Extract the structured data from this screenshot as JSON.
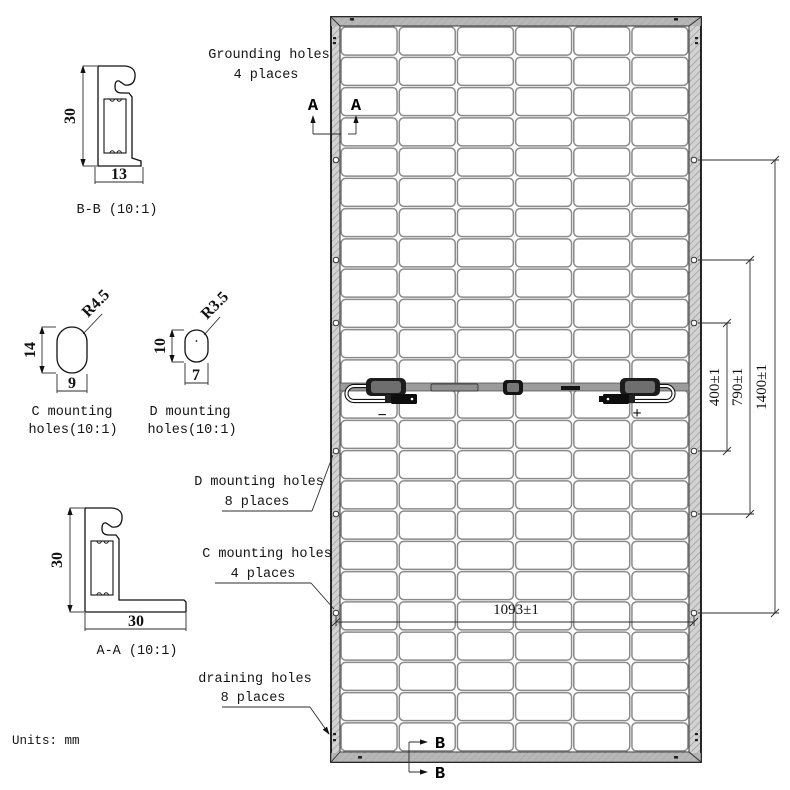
{
  "drawing_title": "solar-panel-rear-view-technical-drawing",
  "units_label": "Units: mm",
  "panel": {
    "columns": 6,
    "rows": 24
  },
  "sections": {
    "a": "A",
    "b": "B"
  },
  "polarity": {
    "minus": "−",
    "plus": "+"
  },
  "dimensions": {
    "width_holes": "1093±1",
    "v400": "400±1",
    "v790": "790±1",
    "v1400": "1400±1"
  },
  "callouts": {
    "grounding": {
      "line1": "Grounding holes",
      "line2": "4 places"
    },
    "d_mounting": {
      "line1": "D mounting holes",
      "line2": "8 places"
    },
    "c_mounting": {
      "line1": "C mounting holes",
      "line2": "4 places"
    },
    "draining": {
      "line1": "draining holes",
      "line2": "8 places"
    }
  },
  "details": {
    "bb_profile": {
      "label": "B-B (10:1)",
      "dim_height": "30",
      "dim_width": "13"
    },
    "aa_profile": {
      "label": "A-A (10:1)",
      "dim_height": "30",
      "dim_width": "30"
    },
    "c_hole": {
      "label_line1": "C mounting",
      "label_line2": "holes(10:1)",
      "dim_height": "14",
      "dim_width": "9",
      "radius": "R4.5"
    },
    "d_hole": {
      "label_line1": "D mounting",
      "label_line2": "holes(10:1)",
      "dim_height": "10",
      "dim_width": "7",
      "radius": "R3.5"
    }
  },
  "colors": {
    "line": "#111111",
    "grid": "#8b8b8b",
    "frame_fill": "#cfcfcf",
    "bar_fill": "#9b9b9b"
  }
}
